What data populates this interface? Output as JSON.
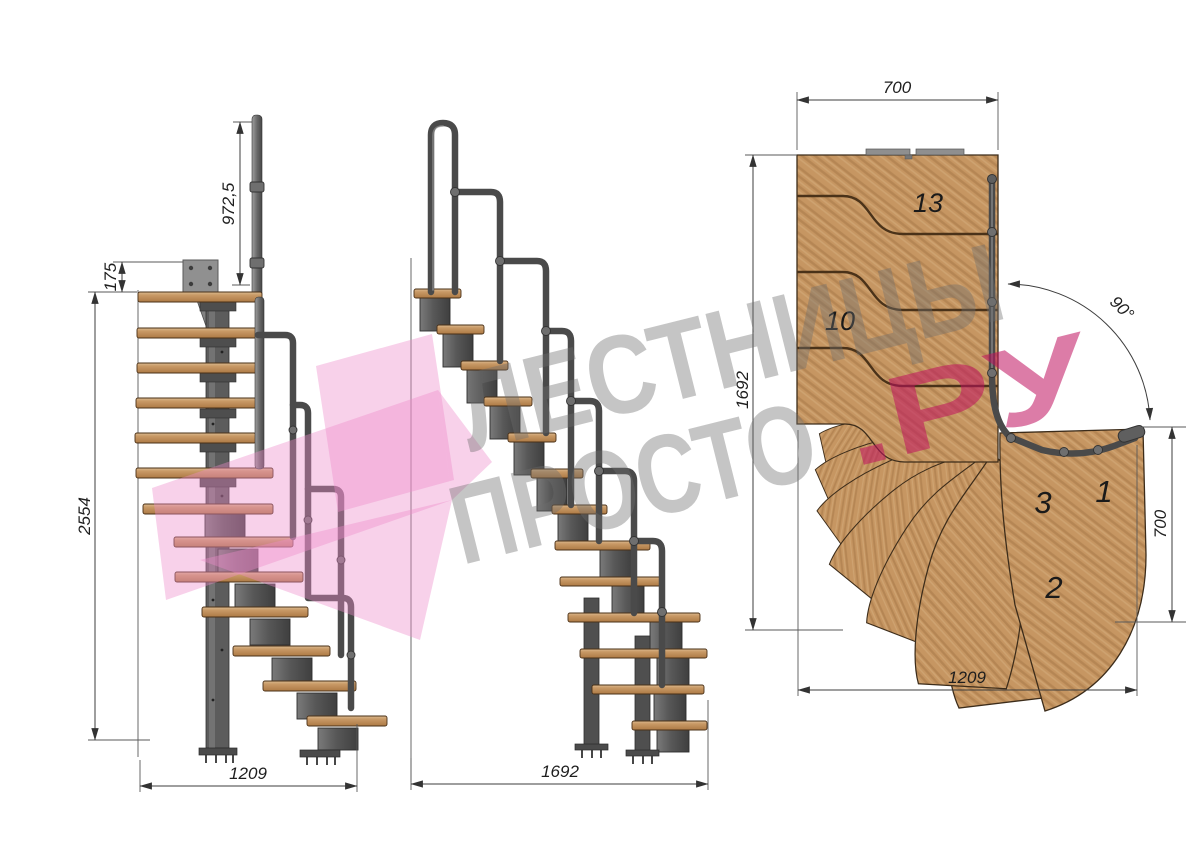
{
  "watermark": {
    "line1": "ЛЕСТНИЦЫ",
    "line2_gray": "ПРОСТО",
    "line2_pink": ".РУ"
  },
  "side_view": {
    "dim_rail_height": "972,5",
    "dim_plate_offset": "175",
    "dim_total_height": "2554",
    "dim_base_width": "1209"
  },
  "front_view": {
    "dim_total_run": "1692"
  },
  "plan_view": {
    "dim_top_width": "700",
    "dim_flight_length": "1692",
    "dim_turn_angle": "90°",
    "dim_entry_depth": "700",
    "dim_bottom_width": "1209",
    "steps": {
      "s13": "13",
      "s10": "10",
      "s3": "3",
      "s1": "1",
      "s2": "2"
    }
  },
  "colors": {
    "wood": "#c69662",
    "metal": "#4a4a4a",
    "watermark_gray": "#7a7a7a",
    "watermark_pink": "#c0105e",
    "logo_pink": "#ee8ccb"
  }
}
